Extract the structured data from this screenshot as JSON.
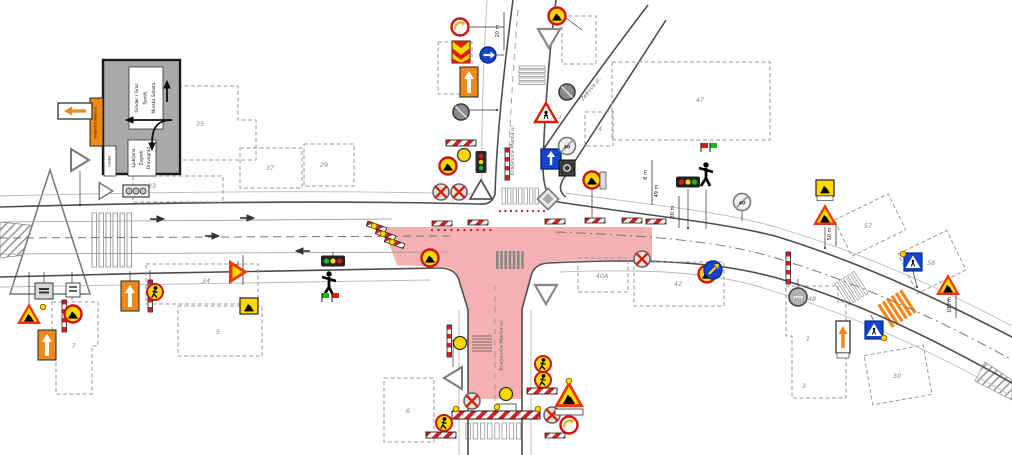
{
  "plan": {
    "streets": {
      "closed": "Kraljeviča Marka ul.",
      "side": "Zelkova ul."
    },
    "board": {
      "tab": "Center",
      "top_lines": [
        "Gradec / Graz",
        "Šentilj",
        "Murska Sobota"
      ],
      "bottom_lines": [
        "Ljubljana",
        "Zagreb",
        "Dravograd"
      ],
      "plate": "Kraljeviča Marka ul."
    },
    "stop": "STOP",
    "speed_end": "40",
    "sign_ref": "2",
    "dims": {
      "d20": "20 m",
      "d30": "30 m",
      "d50a": "50 m",
      "d50b": "50 m",
      "d100": "100 m",
      "d49": "49 m",
      "d8": "8 m"
    },
    "buildings": {
      "b33": "33",
      "b34": "34",
      "b35": "35",
      "b37": "37",
      "b29": "29",
      "b24": "24",
      "b47": "47",
      "b42": "42",
      "b40a": "40A",
      "b48": "48",
      "b1": "1",
      "b3": "3",
      "b30": "30",
      "b57": "57",
      "b58": "58",
      "b6": "6",
      "b7": "7",
      "b5": "5"
    },
    "colors": {
      "work_zone": "#F2A8A8",
      "barrier_red": "#D42020",
      "detour_orange": "#EF8A1A",
      "lamp_yellow": "#FFD800",
      "sign_blue": "#1544CC",
      "flag_green": "#18B818",
      "flag_red": "#D81E05"
    }
  }
}
